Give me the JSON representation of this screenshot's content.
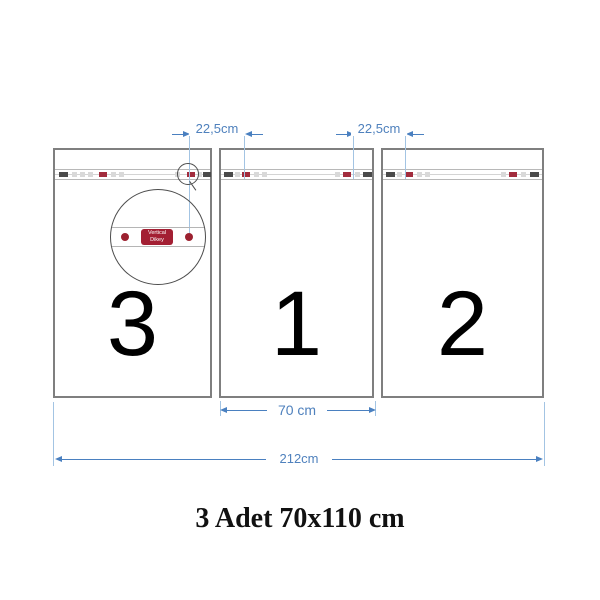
{
  "title": "3 Adet 70x110 cm",
  "panels": [
    {
      "number": "3"
    },
    {
      "number": "1"
    },
    {
      "number": "2"
    }
  ],
  "dimensions": {
    "eyelet_spacing_left": {
      "label": "22,5cm"
    },
    "eyelet_spacing_right": {
      "label": "22,5cm"
    },
    "panel_width": {
      "label": "70 cm"
    },
    "total_width": {
      "label": "212cm"
    }
  },
  "magnifier": {
    "badge_line1": "Vertical",
    "badge_line2": "Dikey"
  },
  "colors": {
    "panel-border": "#7f7f7f",
    "strip-line": "#b8b8b8",
    "mark-dark": "#4a4a4a",
    "mark-light": "#d9d9d9",
    "mark-red": "#a22c3d",
    "eyelet-red": "#9c2130",
    "badge-red": "#a31f33",
    "dim-line": "#4a80c0",
    "dim-ext": "#a3c4e3",
    "dim-text": "#4f81bd",
    "number-black": "#000000",
    "title-black": "#111111",
    "circle-line": "#4d4d4d"
  }
}
